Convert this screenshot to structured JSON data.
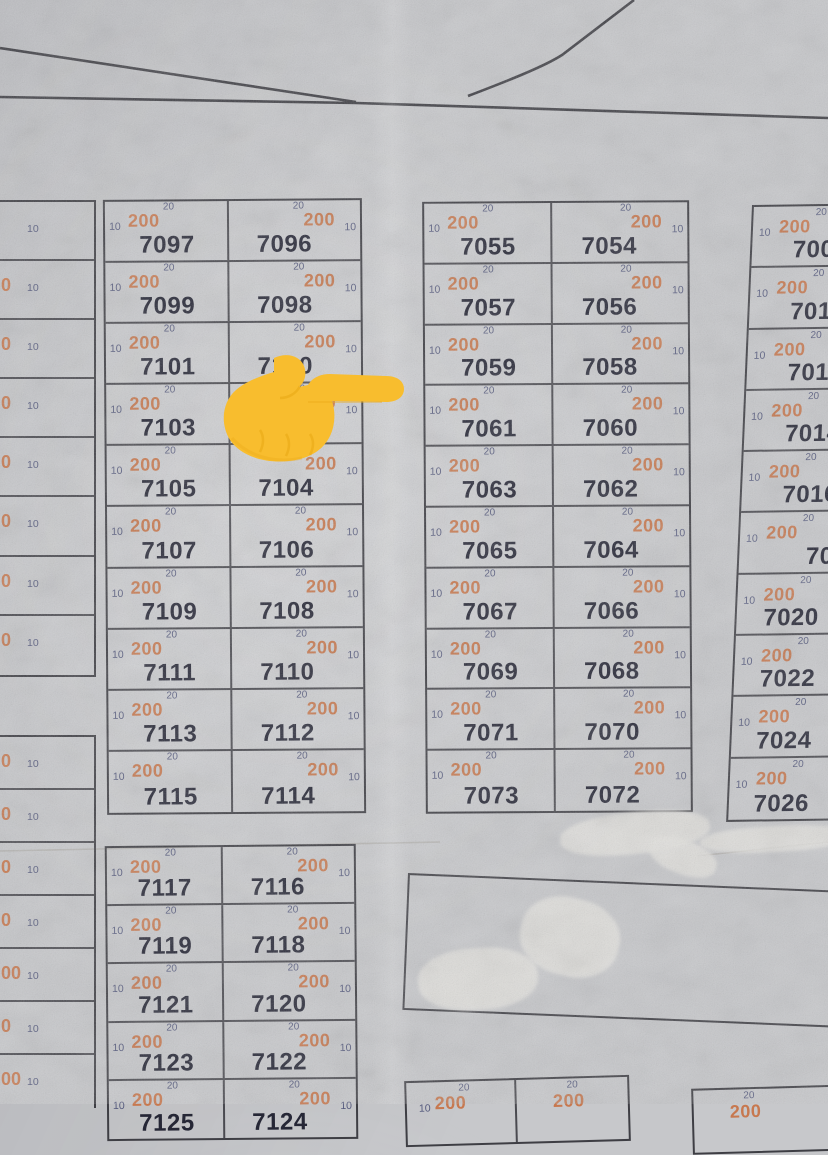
{
  "legend": {
    "front": "10",
    "side": "20",
    "area": "200"
  },
  "pointer": {
    "icon": "backhand-index-pointing-right"
  },
  "colors": {
    "paper": "#c6c7ca",
    "line": "#3e3e44",
    "plot_number_text": "#262736",
    "area_text": "#c7744a",
    "dimension_text": "#565b7e",
    "hand": "#f8bd2e"
  },
  "blocks": {
    "left_edge_upper": {
      "rows": [
        {
          "tail": "",
          "front": "10"
        },
        {
          "tail": "0",
          "front": "10"
        },
        {
          "tail": "0",
          "front": "10"
        },
        {
          "tail": "0",
          "front": "10"
        },
        {
          "tail": "0",
          "front": "10"
        },
        {
          "tail": "0",
          "front": "10"
        },
        {
          "tail": "0",
          "front": "10"
        },
        {
          "tail": "0",
          "front": "10"
        }
      ]
    },
    "left_edge_lower": {
      "rows": [
        {
          "tail": "0",
          "front": "10"
        },
        {
          "tail": "0",
          "front": "10"
        },
        {
          "tail": "0",
          "front": "10"
        },
        {
          "tail": "0",
          "front": "10"
        },
        {
          "tail": "00",
          "front": "10"
        },
        {
          "tail": "0",
          "front": "10"
        },
        {
          "tail": "00",
          "front": "10"
        }
      ]
    },
    "main_left": {
      "rows": [
        [
          "7097",
          "7096"
        ],
        [
          "7099",
          "7098"
        ],
        [
          "7101",
          "7100"
        ],
        [
          "7103",
          "7102"
        ],
        [
          "7105",
          "7104"
        ],
        [
          "7107",
          "7106"
        ],
        [
          "7109",
          "7108"
        ],
        [
          "7111",
          "7110"
        ],
        [
          "7113",
          "7112"
        ],
        [
          "7115",
          "7114"
        ]
      ]
    },
    "center": {
      "rows": [
        [
          "7055",
          "7054"
        ],
        [
          "7057",
          "7056"
        ],
        [
          "7059",
          "7058"
        ],
        [
          "7061",
          "7060"
        ],
        [
          "7063",
          "7062"
        ],
        [
          "7065",
          "7064"
        ],
        [
          "7067",
          "7066"
        ],
        [
          "7069",
          "7068"
        ],
        [
          "7071",
          "7070"
        ],
        [
          "7073",
          "7072"
        ]
      ]
    },
    "right_edge": {
      "rows": [
        "7008",
        "7010",
        "7012",
        "7014",
        "7016",
        "7018",
        "7020",
        "7022",
        "7024",
        "7026"
      ]
    },
    "lower_left": {
      "rows": [
        [
          "7117",
          "7116"
        ],
        [
          "7119",
          "7118"
        ],
        [
          "7121",
          "7120"
        ],
        [
          "7123",
          "7122"
        ],
        [
          "7125",
          "7124"
        ]
      ]
    },
    "bottom_center": {
      "cells": [
        {
          "show_front": true
        },
        {
          "show_front": false
        }
      ]
    },
    "bottom_right": {
      "cells": [
        {
          "show_front": false
        }
      ]
    }
  }
}
